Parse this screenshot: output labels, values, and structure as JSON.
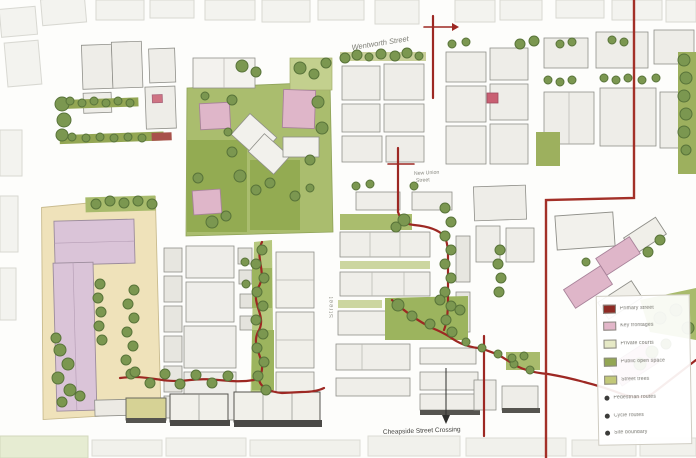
{
  "map": {
    "street_labels": {
      "top": "Wentworth Street",
      "mid_line1": "New Union",
      "mid_line2": "Street",
      "vertical": "Street",
      "bottom": "Cheapside Street Crossing"
    },
    "legend": {
      "items": [
        {
          "label": "Primary street",
          "color": "#8e2a24"
        },
        {
          "label": "Key frontages",
          "color": "#e2b6c9"
        },
        {
          "label": "Private courts",
          "color": "#e6e9c6"
        },
        {
          "label": "Public open space",
          "color": "#93a653"
        },
        {
          "label": "Street trees",
          "color": "#c2c878"
        },
        {
          "label": "Pedestrian routes",
          "color": "#3c3c3a"
        },
        {
          "label": "Cycle routes",
          "color": "#3c3c3a"
        },
        {
          "label": "Site boundary",
          "color": "#3c3c3a"
        }
      ]
    },
    "colors": {
      "route_red": "#9d2823",
      "boundary_red": "#a33028",
      "tree_green": "#7b9750",
      "grass_green": "#a3b968",
      "pink_building": "#dfb6c9",
      "lavender_building": "#dac4d8",
      "cream_court": "#efe2ba"
    }
  }
}
